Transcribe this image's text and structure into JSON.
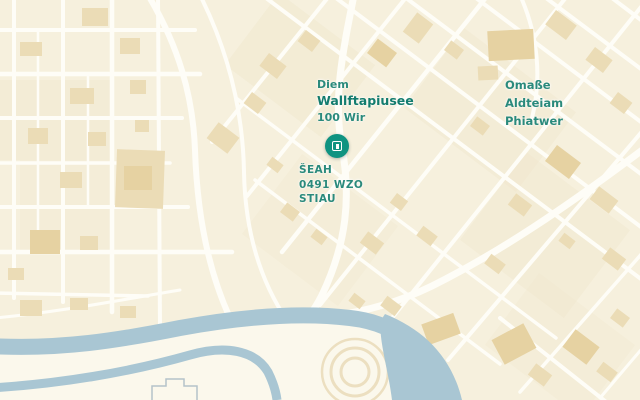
{
  "map": {
    "labels": {
      "district": {
        "line1": "Diem",
        "line2": "Wallftapiusee",
        "line3": "100 Wir"
      },
      "marker": {
        "line1": "ŠEAH",
        "line2": "0491 WZO",
        "line3": "STIAU"
      },
      "area": {
        "line1": "Omaße",
        "line2": "Aldteiam",
        "line3": "Phiatwer"
      }
    },
    "marker_icon": "transit-station-icon"
  },
  "colors": {
    "map_bg": "#f6f0dd",
    "block_shade": "#f0e7cd",
    "building": "#ebdcb6",
    "building_dark": "#e6d2a2",
    "street": "#fefdf7",
    "river": "#a9c6d3",
    "riverbank_pale": "#fbf8ec",
    "label_teal": "#2a8a7c",
    "label_teal_dark": "#137c6e",
    "marker_teal": "#0f9381",
    "footprint_outline": "#b5c2ca",
    "park_ring": "#ecdfc0"
  }
}
